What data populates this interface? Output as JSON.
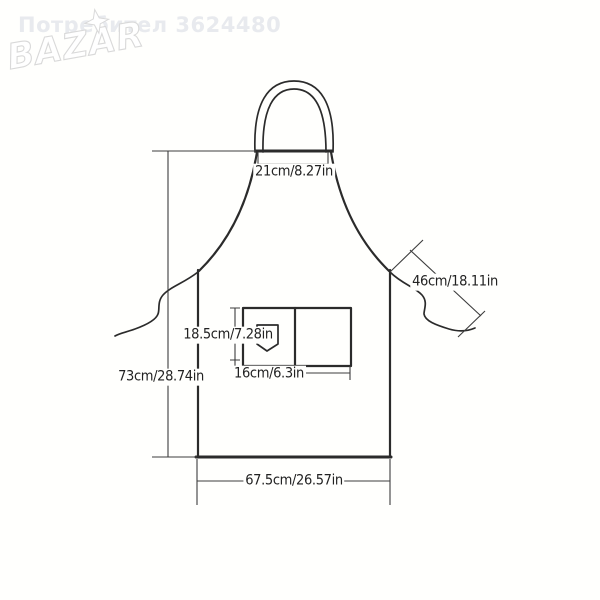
{
  "watermark": "Потребител 3624480",
  "logo": {
    "brand": "BAZAR"
  },
  "diagram": {
    "subject": "apron-size-diagram",
    "labels": {
      "neck_width": "21cm/8.27in",
      "strap_length": "46cm/18.11in",
      "pocket_height": "18.5cm/7.28in",
      "pocket_width": "16cm/6.3in",
      "body_height": "73cm/28.74in",
      "body_width": "67.5cm/26.57in"
    },
    "colors": {
      "line": "#2b2b2b",
      "dimension": "#3d3d3d",
      "watermark": "#e8eaee",
      "logo_outline": "#d9d9d9"
    }
  }
}
